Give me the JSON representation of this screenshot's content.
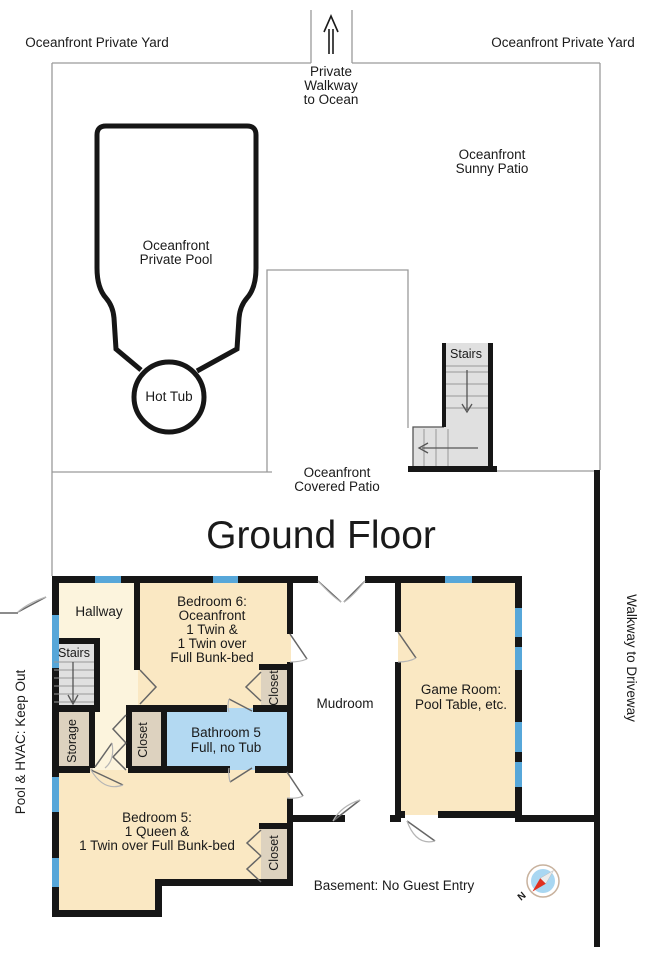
{
  "title": "Ground Floor",
  "colors": {
    "text": "#1a1a1a",
    "wall": "#161616",
    "line": "#9a9a9a",
    "room_cream": "#FAE8C3",
    "room_pale": "#FCF4DD",
    "room_tan": "#DDD2BF",
    "room_blue": "#B3D9F2",
    "window_blue": "#57A7D9",
    "stairs_gray": "#E0E0E0",
    "door": "#666666",
    "arc": "#b5b5b5",
    "compass_blue": "#A9D7F2",
    "compass_red": "#E03020",
    "compass_ring": "#C8B29E"
  },
  "outdoor": {
    "yard_left": "Oceanfront Private Yard",
    "yard_right": "Oceanfront Private Yard",
    "walkway_lines": [
      "Private",
      "Walkway",
      "to Ocean"
    ],
    "sunny_patio_lines": [
      "Oceanfront",
      "Sunny Patio"
    ],
    "pool_lines": [
      "Oceanfront",
      "Private Pool"
    ],
    "hot_tub": "Hot Tub",
    "stairs_label": "Stairs",
    "covered_patio_lines": [
      "Oceanfront",
      "Covered Patio"
    ]
  },
  "notes": {
    "pool_hvac": "Pool & HVAC: Keep Out",
    "walkway_driveway": "Walkway to Driveway",
    "basement": "Basement: No Guest Entry"
  },
  "rooms": {
    "hallway": {
      "label": "Hallway"
    },
    "stairs": {
      "label": "Stairs"
    },
    "storage": {
      "label": "Storage"
    },
    "hall_closet": {
      "label": "Closet"
    },
    "bathroom5": {
      "lines": [
        "Bathroom 5",
        "Full, no Tub"
      ]
    },
    "bedroom6": {
      "lines": [
        "Bedroom 6:",
        "Oceanfront",
        "1 Twin &",
        "1 Twin over",
        "Full Bunk-bed"
      ]
    },
    "bedroom6_closet": {
      "label": "Closet"
    },
    "mudroom": {
      "label": "Mudroom"
    },
    "game_room": {
      "lines": [
        "Game Room:",
        "Pool Table, etc."
      ]
    },
    "bedroom5": {
      "lines": [
        "Bedroom 5:",
        "1 Queen &",
        "1 Twin over Full Bunk-bed"
      ]
    },
    "bedroom5_closet": {
      "label": "Closet"
    }
  },
  "compass": {
    "north": "N"
  }
}
